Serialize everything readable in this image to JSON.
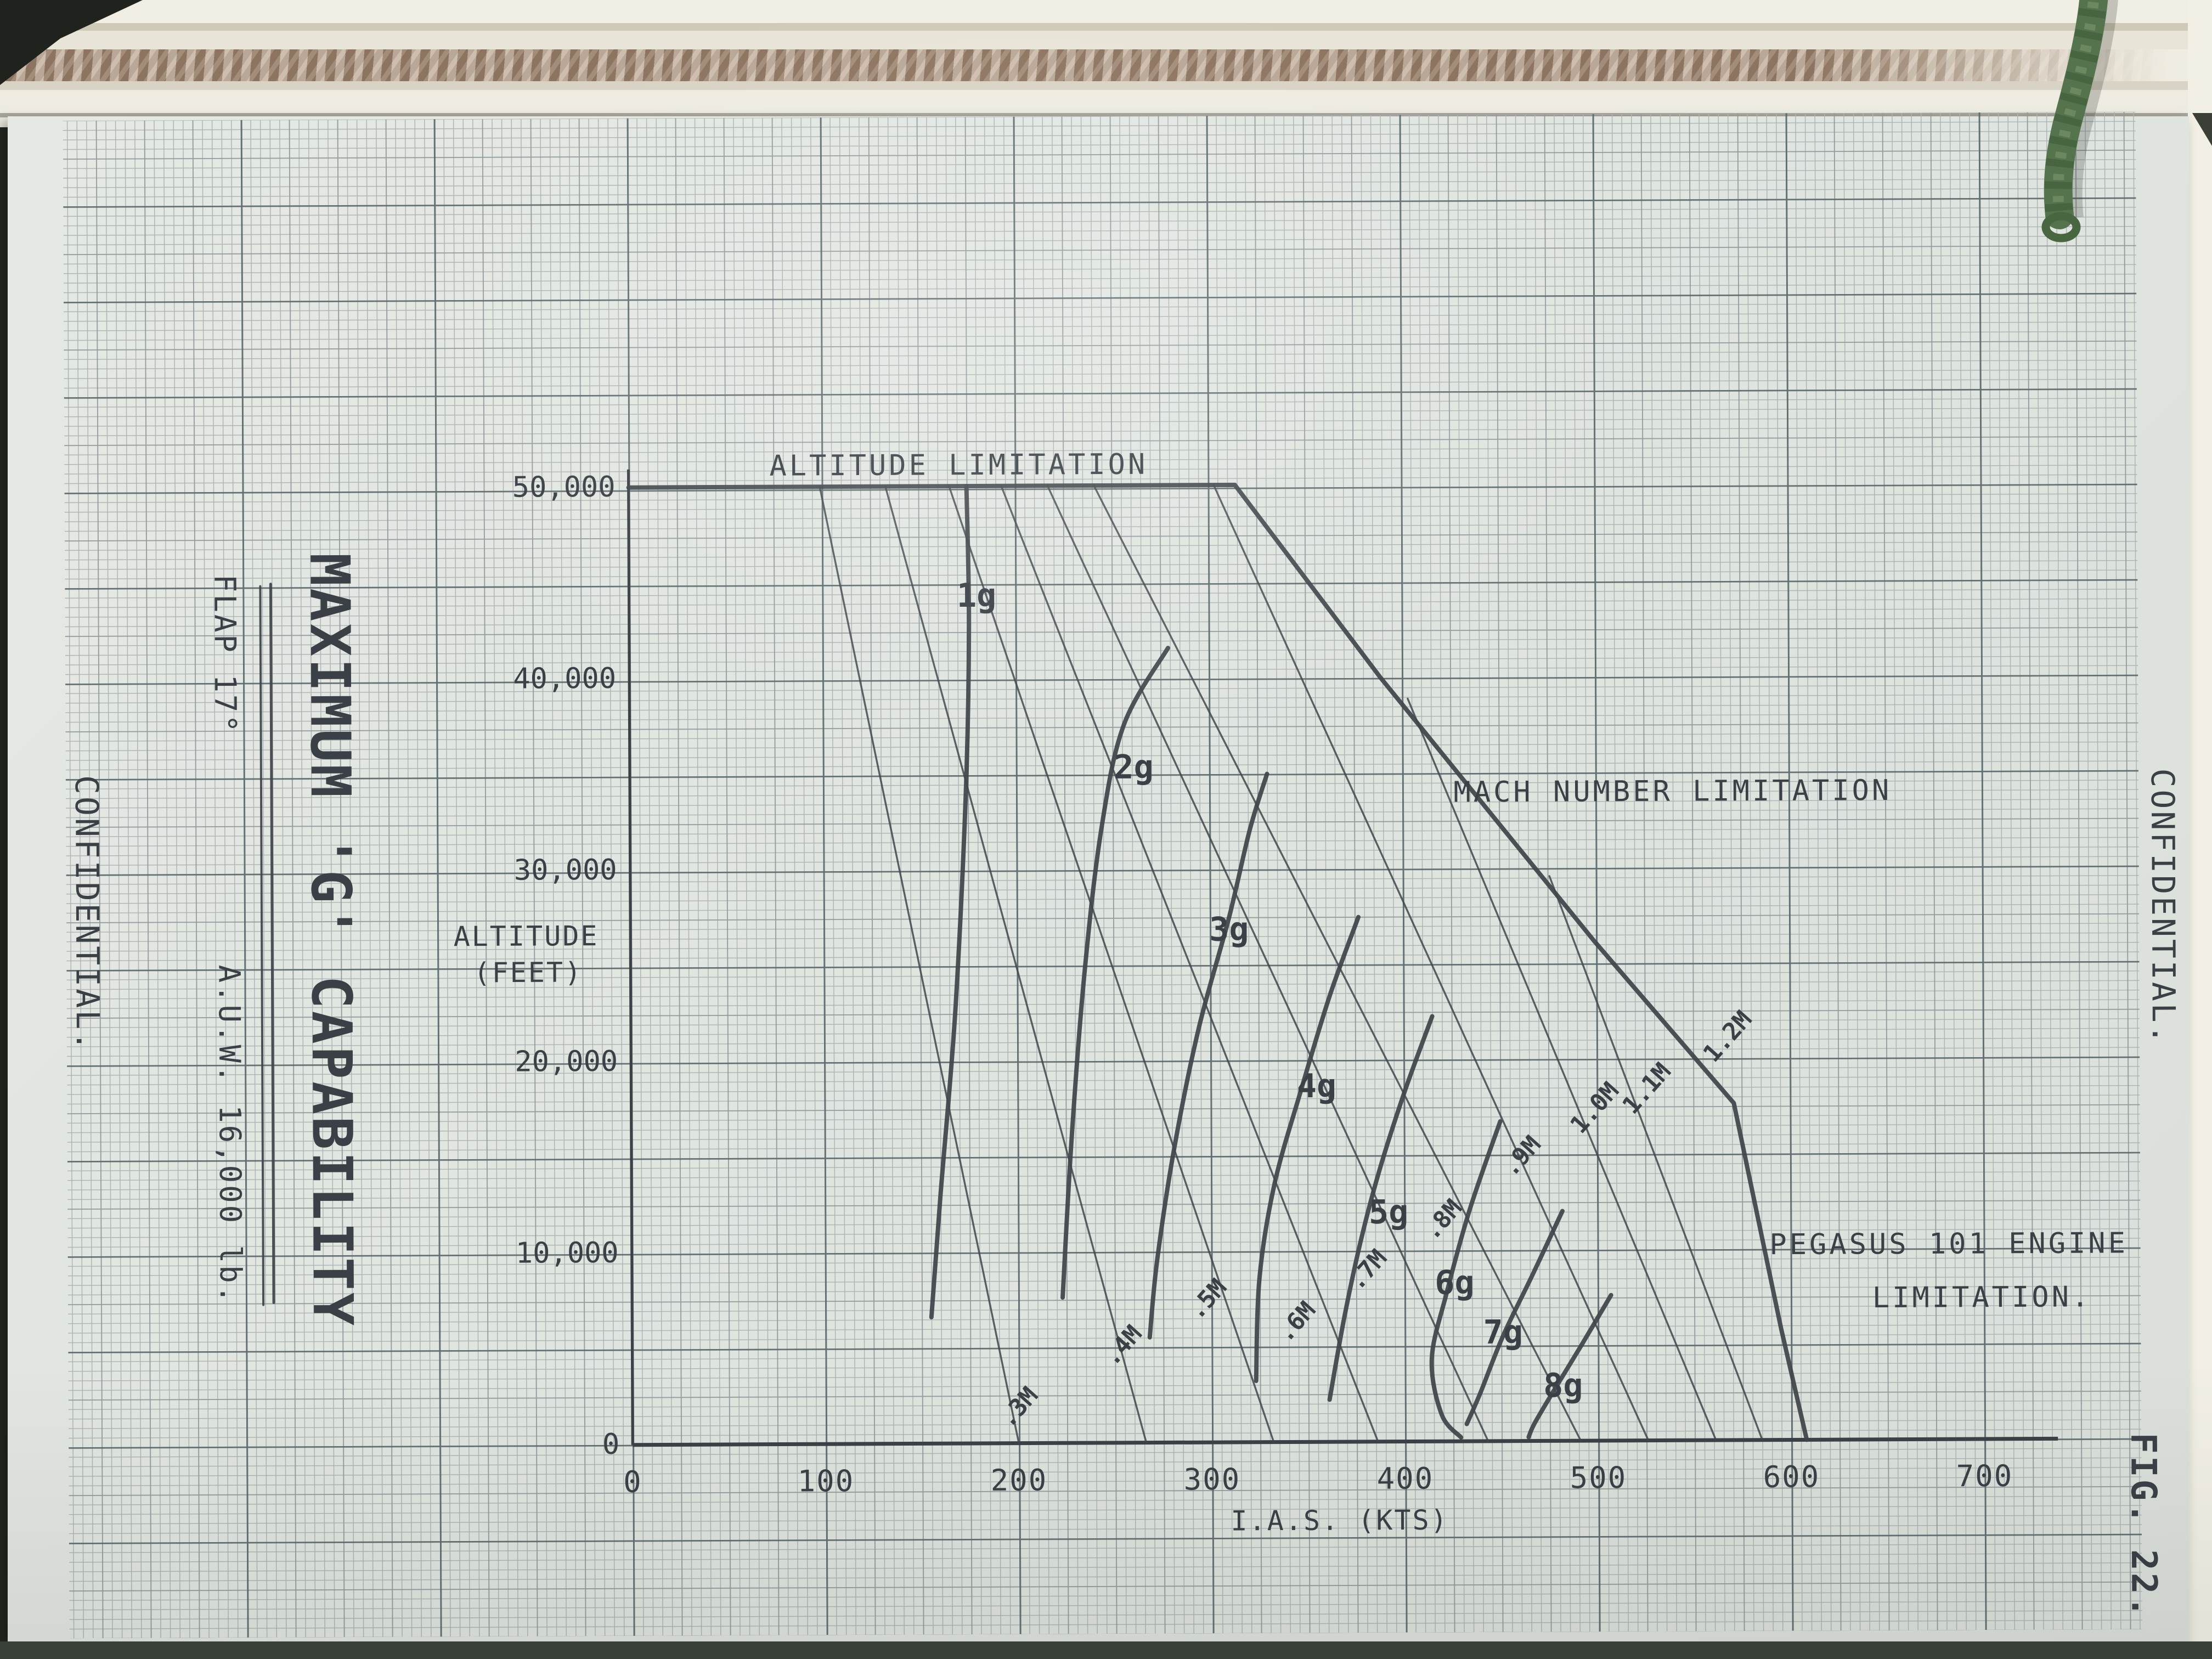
{
  "page": {
    "classification_left": "CONFIDENTIAL.",
    "classification_right": "CONFIDENTIAL.",
    "figure_number": "FIG. 22."
  },
  "title_block": {
    "title": "MAXIMUM 'G' CAPABILITY",
    "flap": "FLAP 17°",
    "auw": "A.U.W. 16,000 lb."
  },
  "chart_data": {
    "type": "line",
    "title": "MAXIMUM 'G' CAPABILITY",
    "xlabel": "I.A.S. (KTS)",
    "ylabel": "ALTITUDE (FEET)",
    "xlim": [
      0,
      700
    ],
    "ylim": [
      0,
      50000
    ],
    "grid": "fine graph paper",
    "x_ticks": [
      {
        "v": 0,
        "label": "0"
      },
      {
        "v": 100,
        "label": "100"
      },
      {
        "v": 200,
        "label": "200"
      },
      {
        "v": 300,
        "label": "300"
      },
      {
        "v": 400,
        "label": "400"
      },
      {
        "v": 500,
        "label": "500"
      },
      {
        "v": 600,
        "label": "600"
      },
      {
        "v": 700,
        "label": "700"
      }
    ],
    "y_ticks": [
      {
        "v": 0,
        "label": "0"
      },
      {
        "v": 10000,
        "label": "10,000"
      },
      {
        "v": 20000,
        "label": "20,000"
      },
      {
        "v": 30000,
        "label": "30,000"
      },
      {
        "v": 40000,
        "label": "40,000"
      },
      {
        "v": 50000,
        "label": "50,000"
      }
    ],
    "annotations": [
      {
        "text": "ALTITUDE LIMITATION",
        "ias": 171,
        "alt": 50600,
        "cls": "ann"
      },
      {
        "text": "MACH NUMBER LIMITATION",
        "ias": 540,
        "alt": 33400,
        "cls": "ann"
      },
      {
        "text": "PEGASUS 101 ENGINE",
        "ias": 682,
        "alt": 9700,
        "cls": "ann"
      },
      {
        "text": "LIMITATION.",
        "ias": 699,
        "alt": 6900,
        "cls": "ann"
      },
      {
        "text": "ALTITUDE",
        "ias": -54,
        "alt": 26100,
        "cls": "axis-label"
      },
      {
        "text": "(FEET)",
        "ias": -53,
        "alt": 24200,
        "cls": "axis-label"
      },
      {
        "text": "I.A.S. (KTS)",
        "ias": 366,
        "alt": -4600,
        "cls": "axis-label"
      }
    ],
    "line_groups": [
      {
        "name": "flight-envelope-boundary",
        "class": "ink bold",
        "smooth": false,
        "label_class": "mlabel",
        "series": [
          {
            "label": "1.2M",
            "label_pos": [
              571,
              20800,
              -48
            ],
            "points": [
              [
                0,
                50000
              ],
              [
                314,
                50000
              ],
              [
                389,
                39900
              ],
              [
                499,
                26100
              ],
              [
                571,
                17600
              ],
              [
                595,
                5800
              ],
              [
                608,
                0
              ]
            ]
          }
        ]
      },
      {
        "name": "g-curves",
        "class": "ink bold",
        "smooth": true,
        "label_class": "glabel",
        "series": [
          {
            "label": "1g",
            "label_pos": [
              180,
              43700,
              0
            ],
            "points": [
              [
                175,
                50000
              ],
              [
                176,
                42700
              ],
              [
                174,
                34000
              ],
              [
                168,
                22500
              ],
              [
                160,
                13000
              ],
              [
                155,
                6600
              ]
            ]
          },
          {
            "label": "2g",
            "label_pos": [
              261,
              34700,
              0
            ],
            "points": [
              [
                279,
                41500
              ],
              [
                256,
                37500
              ],
              [
                244,
                32000
              ],
              [
                235,
                24500
              ],
              [
                228,
                15900
              ],
              [
                223,
                7600
              ]
            ]
          },
          {
            "label": "3g",
            "label_pos": [
              310,
              26200,
              0
            ],
            "points": [
              [
                330,
                34900
              ],
              [
                321,
                32000
              ],
              [
                310,
                27400
              ],
              [
                294,
                21600
              ],
              [
                281,
                15300
              ],
              [
                272,
                9500
              ],
              [
                268,
                5500
              ]
            ]
          },
          {
            "label": "4g",
            "label_pos": [
              355,
              18000,
              0
            ],
            "points": [
              [
                377,
                27400
              ],
              [
                362,
                23300
              ],
              [
                347,
                18400
              ],
              [
                333,
                13500
              ],
              [
                325,
                8600
              ],
              [
                323,
                3200
              ]
            ]
          },
          {
            "label": "5g",
            "label_pos": [
              392,
              11400,
              0
            ],
            "points": [
              [
                415,
                22200
              ],
              [
                401,
                18400
              ],
              [
                388,
                14400
              ],
              [
                378,
                10700
              ],
              [
                369,
                6600
              ],
              [
                361,
                2200
              ]
            ]
          },
          {
            "label": "6g",
            "label_pos": [
              426,
              7700,
              0
            ],
            "points": [
              [
                450,
                16700
              ],
              [
                434,
                12100
              ],
              [
                422,
                7800
              ],
              [
                414,
                4300
              ],
              [
                419,
                1400
              ],
              [
                429,
                200
              ]
            ]
          },
          {
            "label": "7g",
            "label_pos": [
              451,
              5100,
              0
            ],
            "points": [
              [
                482,
                12000
              ],
              [
                466,
                8600
              ],
              [
                451,
                5500
              ],
              [
                439,
                2500
              ],
              [
                432,
                900
              ]
            ]
          },
          {
            "label": "8g",
            "label_pos": [
              482,
              2300,
              0
            ],
            "points": [
              [
                507,
                7600
              ],
              [
                491,
                4900
              ],
              [
                477,
                2600
              ],
              [
                467,
                900
              ],
              [
                464,
                200
              ]
            ]
          }
        ]
      },
      {
        "name": "mach-lines",
        "class": "ink thin",
        "smooth": false,
        "label_class": "mlabel",
        "series": [
          {
            "label": ".3M",
            "label_pos": [
              203,
              1600,
              -48
            ],
            "points": [
              [
                99,
                50000
              ],
              [
                200,
                0
              ]
            ]
          },
          {
            "label": ".4M",
            "label_pos": [
              257,
              4800,
              -48
            ],
            "points": [
              [
                133,
                50000
              ],
              [
                266,
                0
              ]
            ]
          },
          {
            "label": ".5M",
            "label_pos": [
              301,
              7200,
              -48
            ],
            "points": [
              [
                166,
                50000
              ],
              [
                332,
                0
              ]
            ]
          },
          {
            "label": ".6M",
            "label_pos": [
              347,
              6000,
              -48
            ],
            "points": [
              [
                193,
                50000
              ],
              [
                386,
                0
              ]
            ]
          },
          {
            "label": ".7M",
            "label_pos": [
              384,
              8700,
              -48
            ],
            "points": [
              [
                217,
                50000
              ],
              [
                443,
                0
              ]
            ]
          },
          {
            "label": ".8M",
            "label_pos": [
              423,
              11300,
              -48
            ],
            "points": [
              [
                241,
                50000
              ],
              [
                491,
                0
              ]
            ]
          },
          {
            "label": ".9M",
            "label_pos": [
              464,
              14600,
              -48
            ],
            "points": [
              [
                303,
                50000
              ],
              [
                526,
                0
              ]
            ]
          },
          {
            "label": "1.0M",
            "label_pos": [
              502,
              17100,
              -48
            ],
            "points": [
              [
                403,
                38800
              ],
              [
                561,
                0
              ]
            ]
          },
          {
            "label": "1.1M",
            "label_pos": [
              529,
              18100,
              -48
            ],
            "points": [
              [
                476,
                29500
              ],
              [
                585,
                0
              ]
            ]
          }
        ]
      }
    ]
  }
}
